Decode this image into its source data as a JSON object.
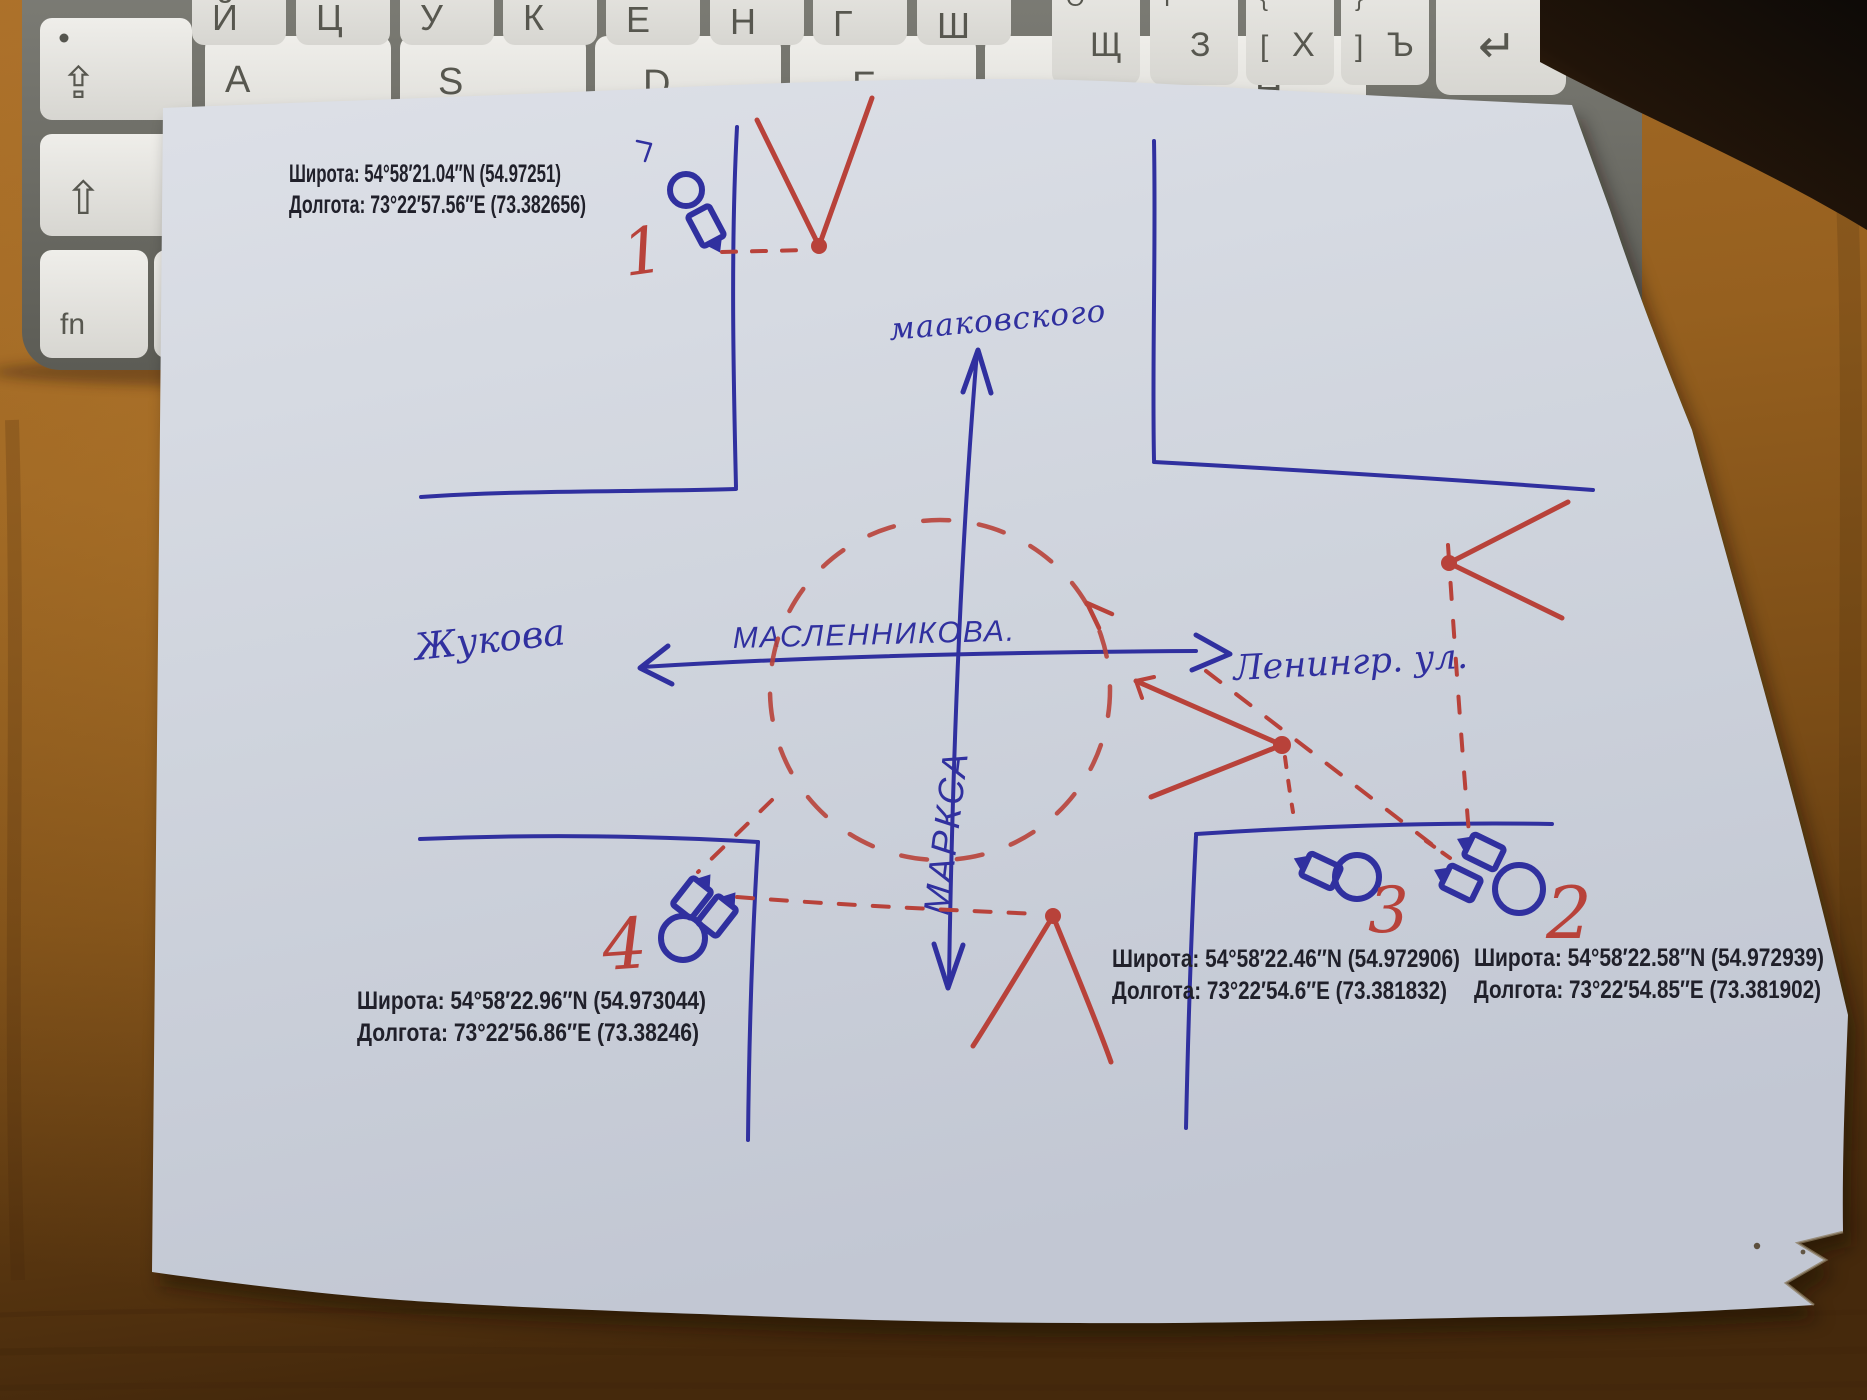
{
  "keyboard": {
    "top_row": [
      {
        "main": "Й"
      },
      {
        "main": "Ц"
      },
      {
        "main": "У"
      },
      {
        "main": "К"
      },
      {
        "main": "Е"
      },
      {
        "main": "Н"
      },
      {
        "main": "Г"
      },
      {
        "main": "Ш"
      },
      {
        "main": "Щ",
        "top": "O"
      },
      {
        "main": "З",
        "top": "P"
      },
      {
        "main": "Х",
        "top": "{",
        "side": "["
      },
      {
        "main": "Ъ",
        "top": "}",
        "side": "]"
      }
    ],
    "home_row": [
      "A",
      "S",
      "D",
      "F",
      "G",
      "H"
    ],
    "modifiers": {
      "caps": "⇪",
      "shift": "⇧",
      "fn": "fn",
      "ctrl": "ctrl",
      "return": "↵"
    }
  },
  "paper": {
    "streets": {
      "north_label": "мааковского",
      "west_label": "Жукова",
      "center_label": "МАСЛЕННИКОВА.",
      "east_label": "Ленингр. ул.",
      "south_label": "МАРКСА"
    },
    "cameras": [
      {
        "number": "1",
        "lat_line": "Широта: 54°58′21.04″N (54.97251)",
        "lon_line": "Долгота: 73°22′57.56″E (73.382656)"
      },
      {
        "number": "2",
        "lat_line": "Широта: 54°58′22.58″N (54.972939)",
        "lon_line": "Долгота: 73°22′54.85″E (73.381902)"
      },
      {
        "number": "3",
        "lat_line": "Широта: 54°58′22.46″N (54.972906)",
        "lon_line": "Долгота: 73°22′54.6″E (73.381832)"
      },
      {
        "number": "4",
        "lat_line": "Широта: 54°58′22.96″N (54.973044)",
        "lon_line": "Долгота: 73°22′56.86″E (73.38246)"
      }
    ]
  },
  "colors": {
    "pen_blue": "#30309f",
    "pen_red": "#b8423a",
    "printed_text": "#20202a",
    "paper": "#cfd4dd",
    "wood_light": "#a86d28",
    "wood_dark": "#45290c",
    "key_fill": "#e7e6e2",
    "keyboard_frame": "#6f6f68"
  }
}
